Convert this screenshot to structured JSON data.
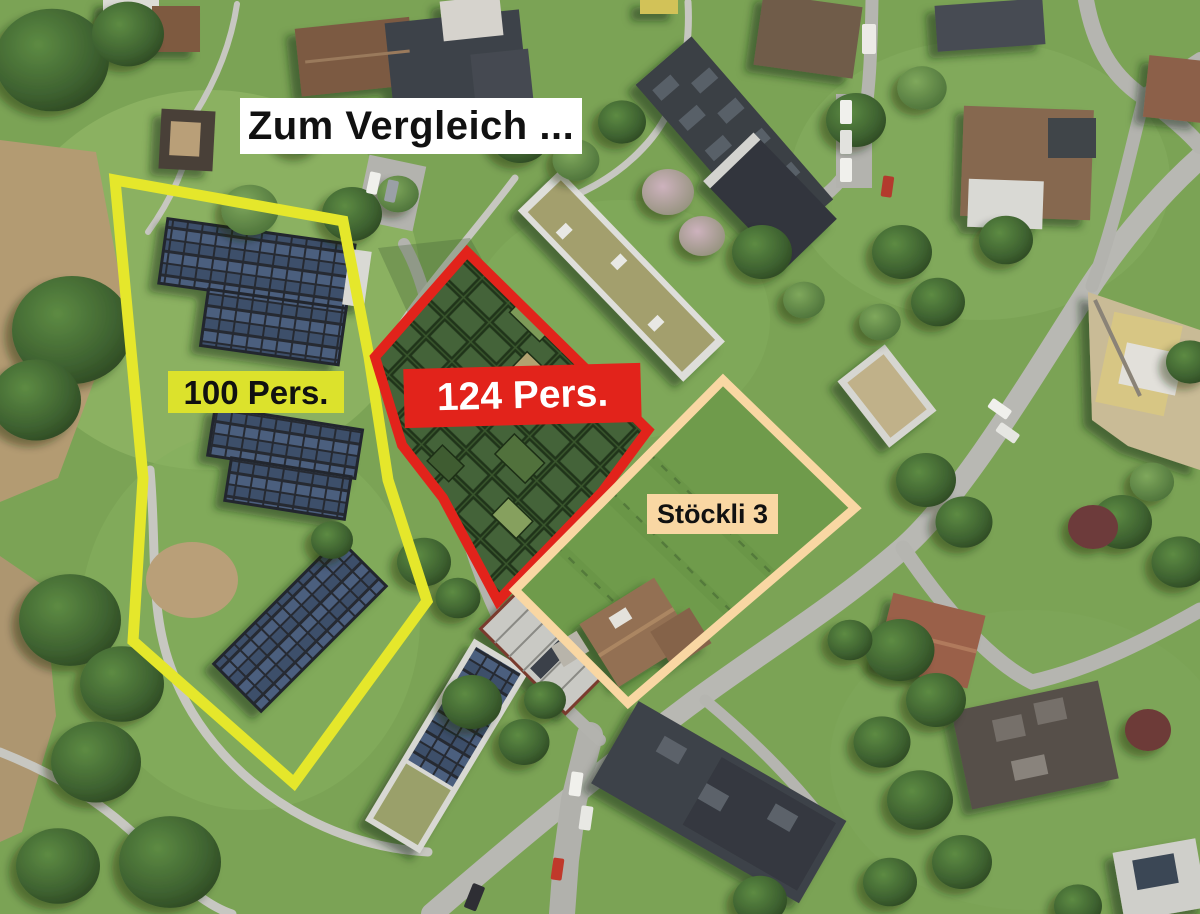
{
  "title": {
    "text": "Zum Vergleich ...",
    "background": "#ffffff",
    "text_color": "#111111"
  },
  "overlays": {
    "site_100": {
      "label": "100 Pers.",
      "outline_color": "#e5e72b",
      "label_background": "#dce22c",
      "label_text_color": "#111111"
    },
    "site_124": {
      "label": "124 Pers.",
      "outline_color": "#e2231b",
      "label_background": "#e2231b",
      "label_text_color": "#ffffff"
    },
    "site_stoeckli": {
      "label": "Stöckli 3",
      "outline_color": "#f9d7a3",
      "label_background": "#f9d7a3",
      "label_text_color": "#111111"
    }
  }
}
